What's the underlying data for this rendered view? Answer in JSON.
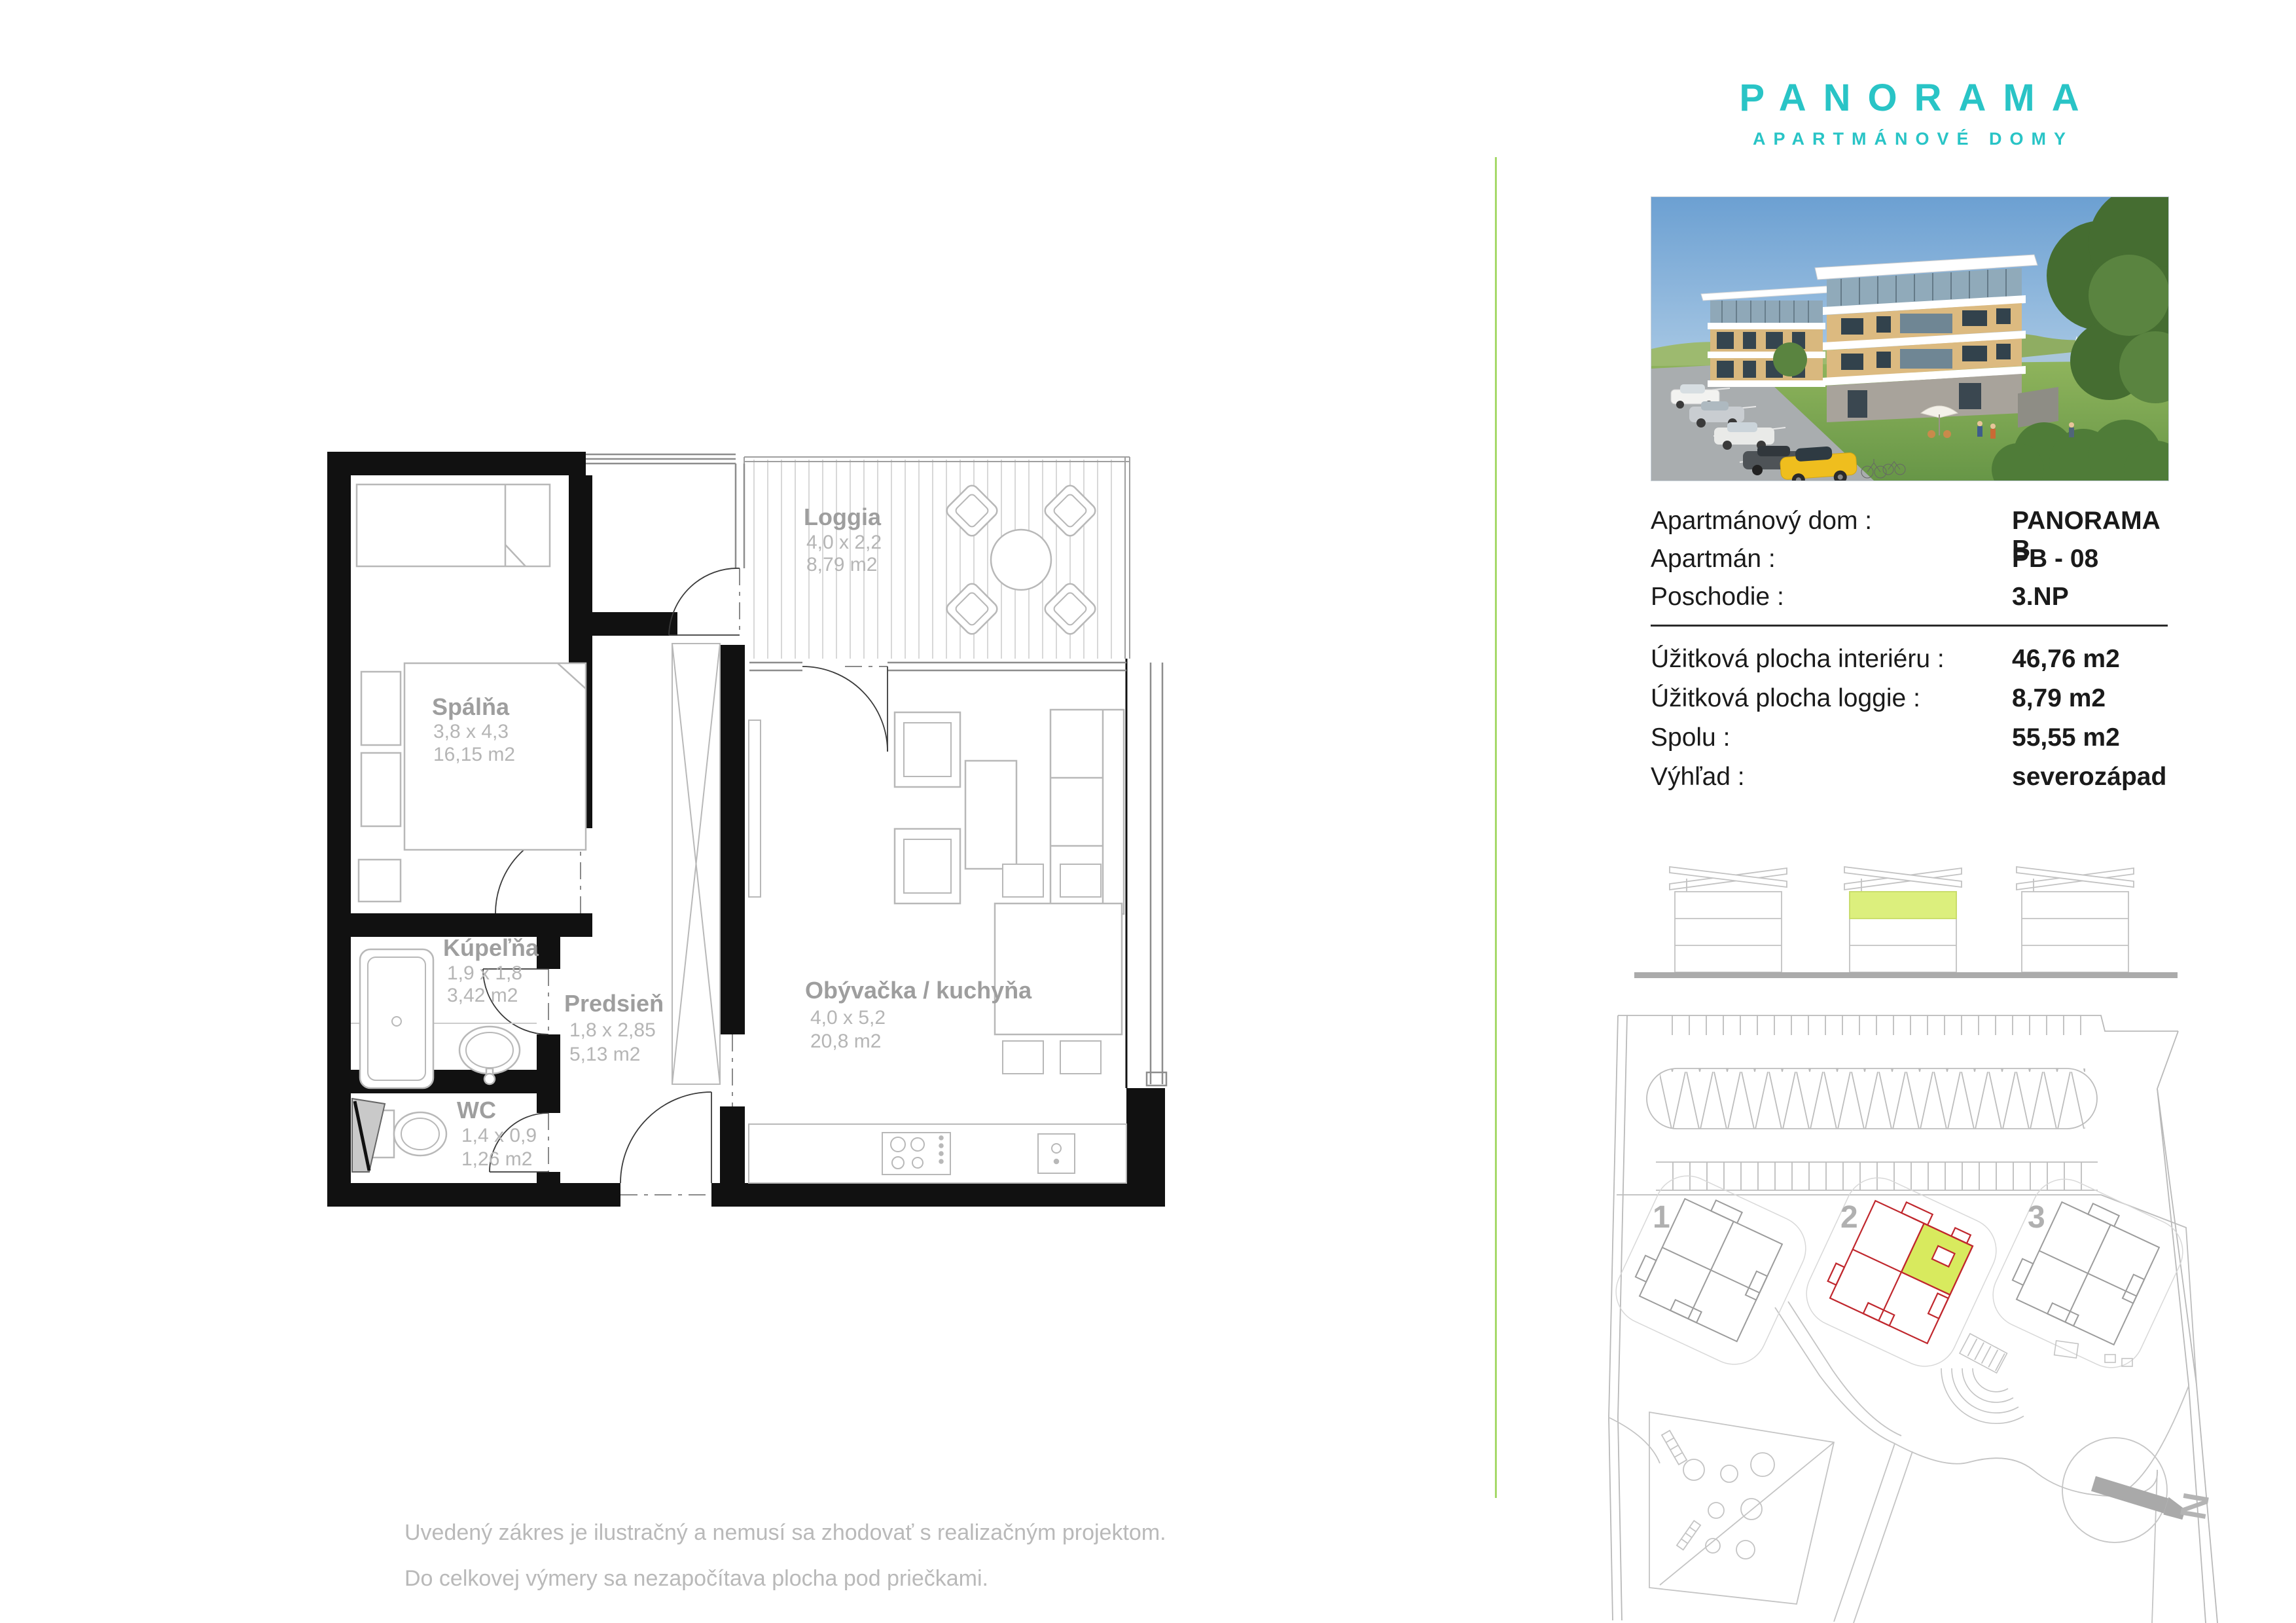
{
  "logo": {
    "title": "PANORAMA",
    "subtitle": "APARTMÁNOVÉ DOMY"
  },
  "info": {
    "rows_top": [
      {
        "label": "Apartmánový dom :",
        "value": "PANORAMA B"
      },
      {
        "label": "Apartmán :",
        "value": "PB - 08"
      },
      {
        "label": "Poschodie :",
        "value": "3.NP"
      }
    ],
    "rows_bottom": [
      {
        "label": "Úžitková plocha interiéru :",
        "value": "46,76 m2"
      },
      {
        "label": "Úžitková plocha loggie :",
        "value": "8,79 m2"
      },
      {
        "label": "Spolu :",
        "value": "55,55 m2"
      },
      {
        "label": "Výhľad :",
        "value": "severozápad"
      }
    ]
  },
  "rooms": {
    "spalna": {
      "name": "Spálňa",
      "dim": "3,8 x 4,3",
      "area": "16,15 m2"
    },
    "loggia": {
      "name": "Loggia",
      "dim": "4,0 x 2,2",
      "area": "8,79 m2"
    },
    "kupelna": {
      "name": "Kúpeľňa",
      "dim": "1,9 x 1,8",
      "area": "3,42 m2"
    },
    "predsien": {
      "name": "Predsieň",
      "dim": "1,8 x 2,85",
      "area": "5,13 m2"
    },
    "wc": {
      "name": "WC",
      "dim": "1,4 x 0,9",
      "area": "1,26 m2"
    },
    "obyvacka": {
      "name": "Obývačka / kuchyňa",
      "dim": "4,0 x 5,2",
      "area": "20,8 m2"
    }
  },
  "site": {
    "labels": [
      "1",
      "2",
      "3"
    ],
    "north": "N"
  },
  "disclaimer": {
    "line1": "Uvedený zákres je ilustračný a nemusí sa zhodovať s realizačným projektom.",
    "line2": "Do celkovej výmery sa nezapočítava plocha pod priečkami."
  },
  "colors": {
    "brand_teal": "#29c4c6",
    "divider_green": "#a6d96a",
    "unit_lime": "#d8ea5e",
    "elevation_lime": "#dcef7d",
    "highlight_red": "#c0272d"
  }
}
